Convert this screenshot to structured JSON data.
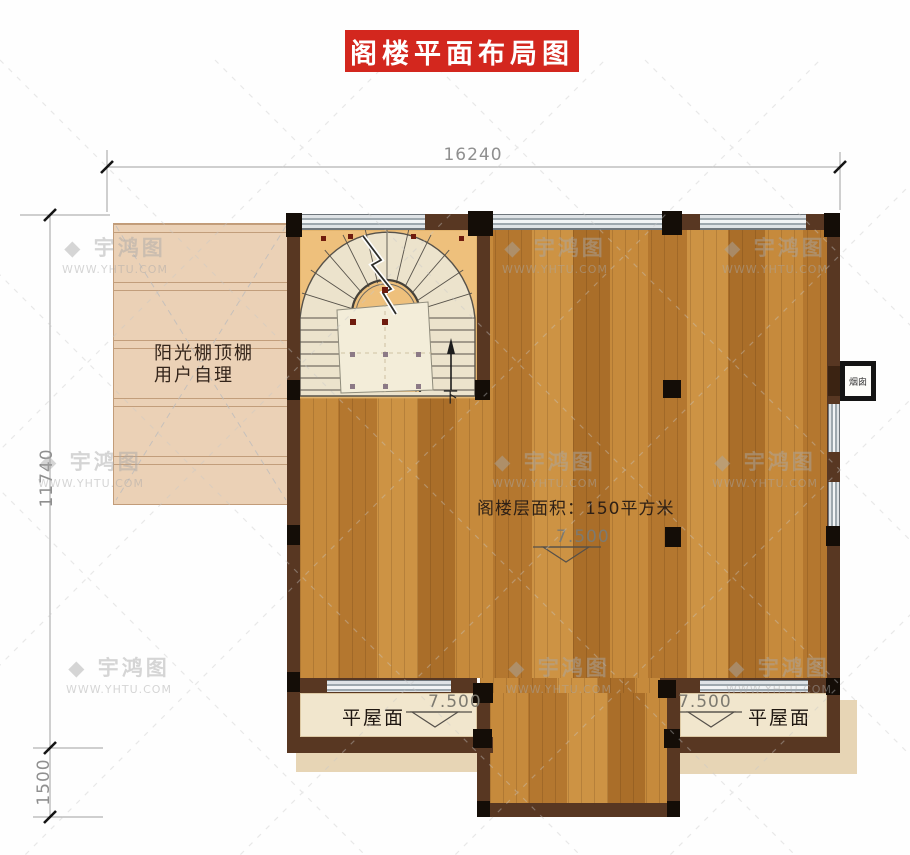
{
  "title": "阁楼平面布局图",
  "dimensions": {
    "width_top": "16240",
    "height_left": "11740",
    "height_bottom_left": "1500"
  },
  "room": {
    "area_label": "阁楼层面积：150平方米",
    "level_center": "7.500",
    "stairs_down_label": "下"
  },
  "sunroom": {
    "line1": "阳光棚顶棚",
    "line2": "用户自理"
  },
  "roof_left": {
    "level": "7.500",
    "label": "平屋面"
  },
  "roof_right": {
    "level": "7.500",
    "label": "平屋面"
  },
  "chimney_label": "烟囱",
  "watermark": {
    "icon": "◆",
    "logo": "宇鸿图",
    "url": "WWW.YHTU.COM"
  },
  "colors": {
    "banner_red": "#d3271e",
    "wall_brown": "#583722",
    "column_black": "#140d07",
    "wood_floor": "#c1843a",
    "stair_sand": "#eec07c",
    "tread_cream": "#ece3cc",
    "sunroom_beige": "#ebd1b6",
    "balcony_cream": "#f1e6cd",
    "window_gray": "#c3c9ce",
    "dimension_gray": "#8f8f8f"
  }
}
